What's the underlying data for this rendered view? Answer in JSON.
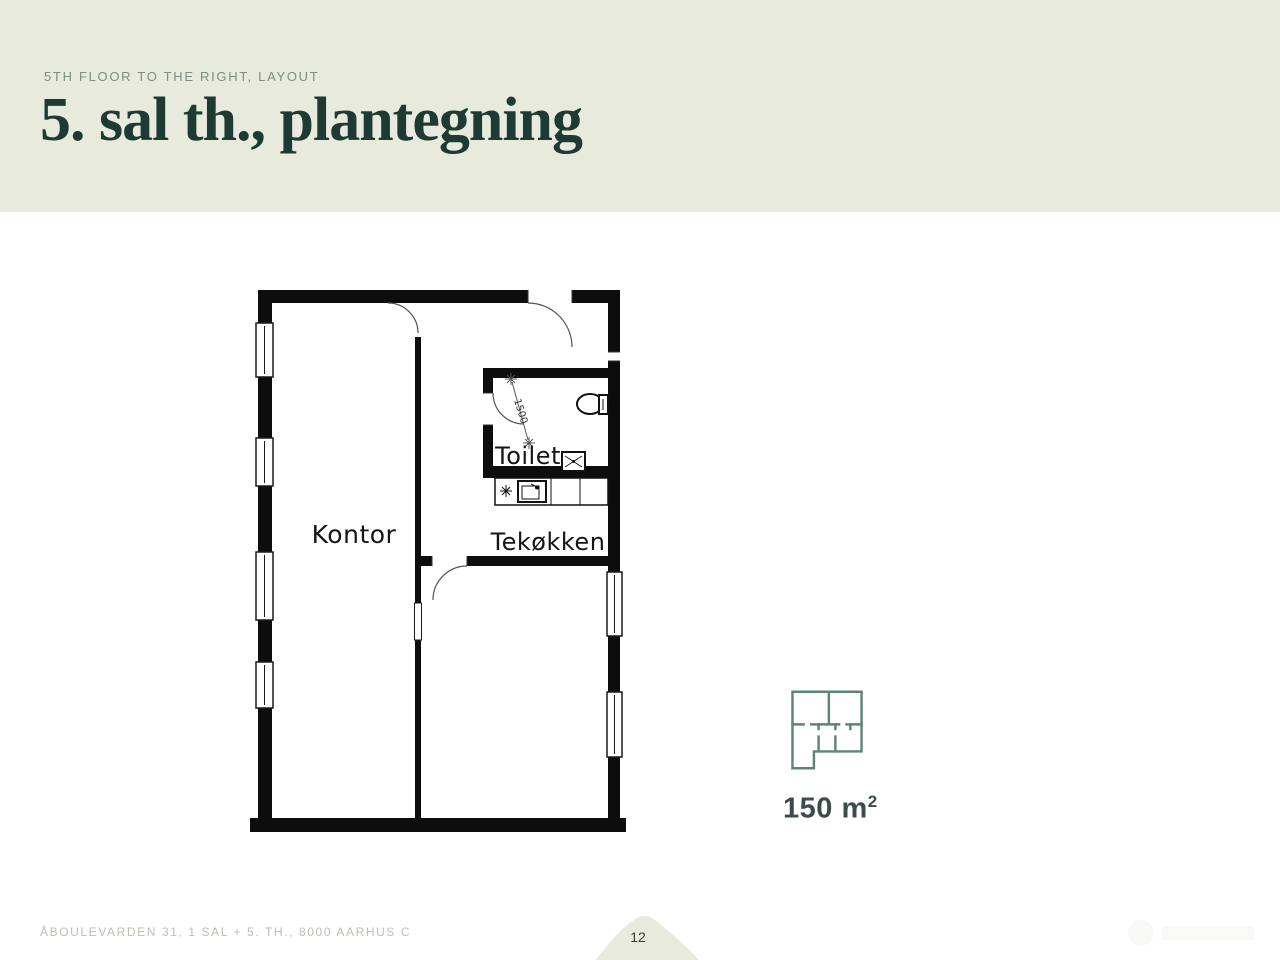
{
  "header": {
    "eyebrow": "5TH FLOOR TO THE RIGHT, LAYOUT",
    "title": "5. sal th., plantegning"
  },
  "floorplan": {
    "room_kontor": "Kontor",
    "room_toilet": "Toilet",
    "room_tekokken": "Tekøkken",
    "dimension_label": "1500"
  },
  "area_card": {
    "value": "150 m",
    "superscript": "2"
  },
  "footer": {
    "address": "ÅBOULEVARDEN 31, 1 SAL + 5. TH., 8000 AARHUS C",
    "page_number": "12"
  },
  "colors": {
    "header_bg": "#e8eade",
    "title_green": "#1d3b33",
    "eyebrow_gray": "#7f8d84",
    "plan_ink": "#0d0d0d",
    "accent_teal": "#5d8478",
    "area_text": "#3c4b4b",
    "footer_text": "#babfb3",
    "mound": "#e8eade"
  }
}
